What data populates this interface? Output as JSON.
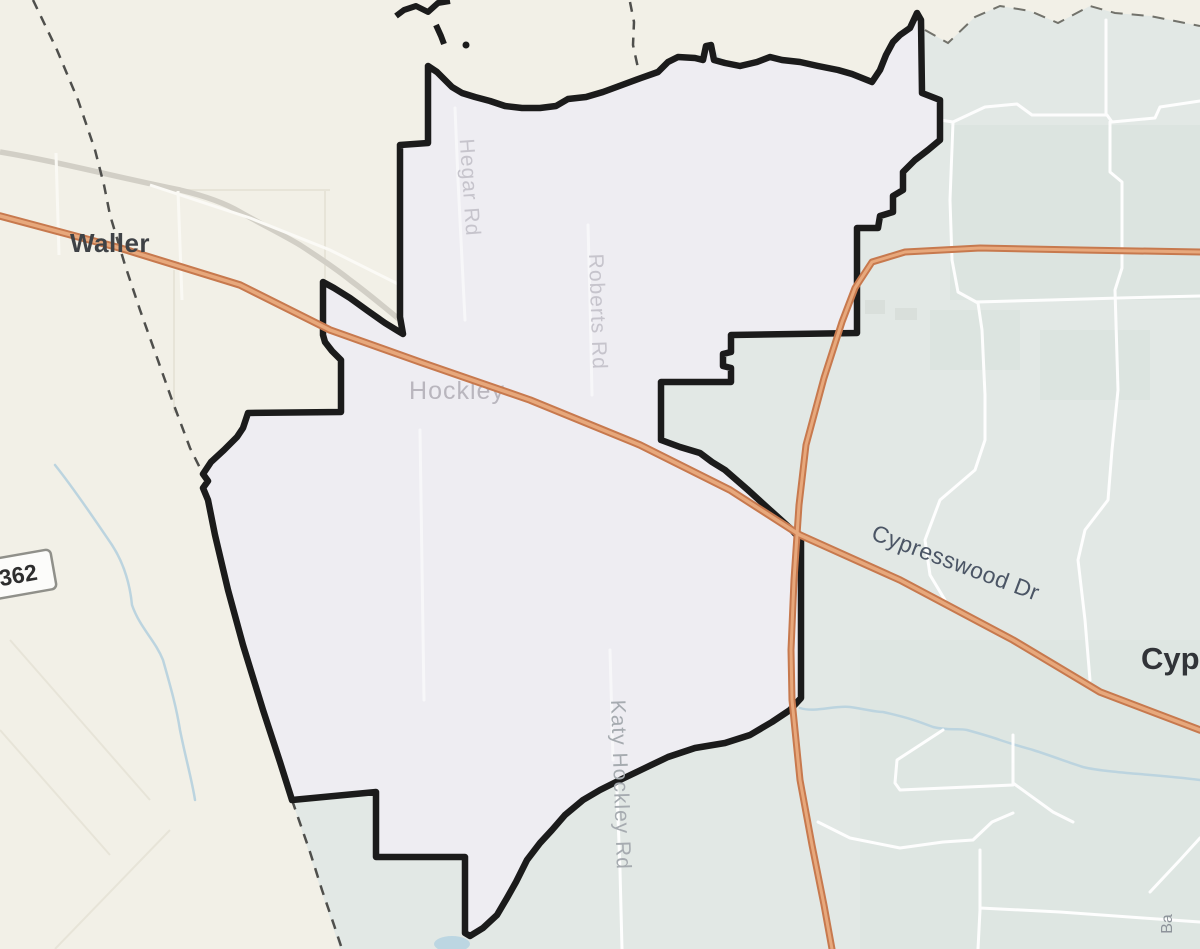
{
  "map": {
    "labels": {
      "city_waller": "Waller",
      "city_hockley": "Hockley",
      "city_cypress_partial": "Cyp",
      "road_hegar": "Hegar Rd",
      "road_roberts": "Roberts Rd",
      "road_katy_hockley": "Katy Hockley Rd",
      "road_cypresswood": "Cypresswood Dr",
      "road_partial_ba": "Ba",
      "shield_362": "362"
    },
    "colors": {
      "county_west_bg": "#f2f0e7",
      "county_east_bg": "#e2e8e5",
      "cdp_fill": "#eeedf2",
      "cdp_boundary": "#1b1b1b",
      "highway_casing": "#c7794e",
      "highway_fill": "#e7a87c",
      "minor_road": "#ffffff",
      "gray_road": "#d2cfc6",
      "county_line": "#4f4f4c",
      "water": "#b9d2de"
    }
  }
}
